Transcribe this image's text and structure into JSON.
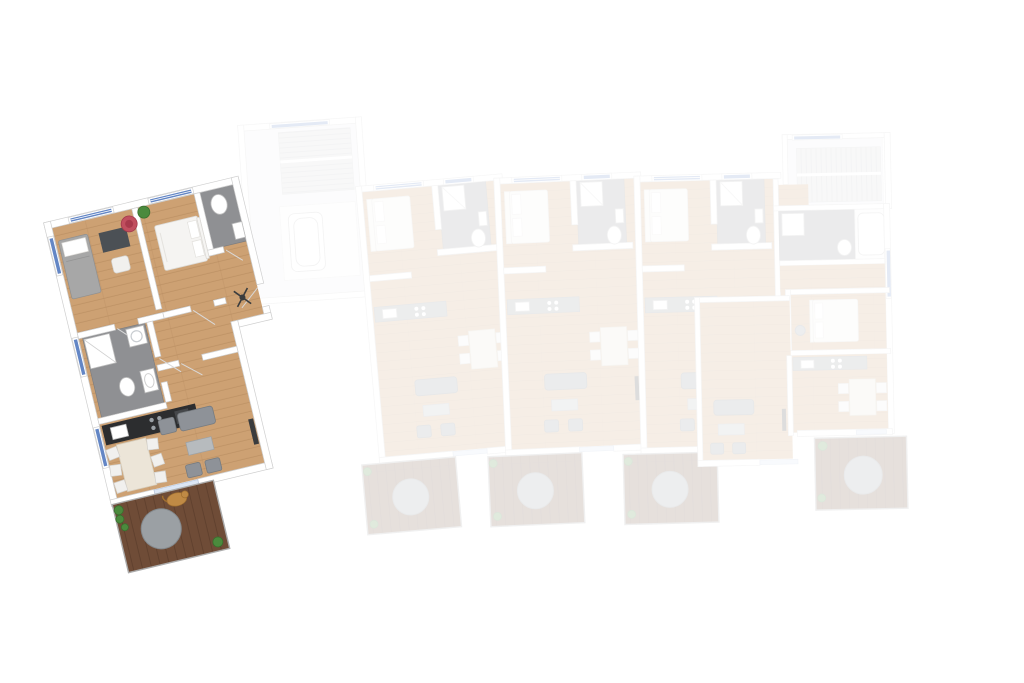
{
  "scene": {
    "kind": "residential-floor-plan-3d-top-view",
    "units_total": 5,
    "highlighted_unit": "unit-1",
    "faded_units": 4,
    "stair_cores": 2
  },
  "colors": {
    "background": "#ffffff",
    "wall_fill": "#ffffff",
    "wall_stroke": "#cfcfcf",
    "wood_floor": "#cda173",
    "wood_plank_line": "#b78c5f",
    "deck_wood": "#6f4c37",
    "deck_plank_line": "#5d3e2c",
    "tile_gray": "#8f9093",
    "tile_dark": "#7a7b7e",
    "window_blue": "#6386c5",
    "window_frame": "#ffffff",
    "glass_blue": "#dce6f4",
    "kitchen_dark": "#2c2d2f",
    "counter_gray": "#92979c",
    "sofa_gray": "#8e9298",
    "sofa_dark": "#767b80",
    "coffee_table": "#b7bbbe",
    "bed_white": "#f5f4f2",
    "bed_outline": "#dcdad6",
    "bed_gray": "#a7a7a7",
    "pillow_white": "#ffffff",
    "chair_white": "#f1f0ee",
    "chair_stroke": "#d2d0cc",
    "desk_dark": "#4b5055",
    "pouf_red": "#c14f5f",
    "plant_green": "#4b8a3d",
    "plant_dark": "#39702e",
    "dog_tan": "#c08a45",
    "stairs_light": "#d7d8da",
    "stairs_stripe": "#bdbfc2",
    "table_round_gray": "#9ba0a4",
    "swing_line": "#d9d9d9",
    "faded_opacity": "0.17"
  },
  "units": [
    {
      "id": "unit-1",
      "state": "highlighted",
      "rooms": [
        "bedroom",
        "master-bedroom",
        "en-suite-wc",
        "bathroom",
        "open-kitchen",
        "living-dining-room",
        "hallway",
        "balcony"
      ],
      "furniture": [
        "single-bed",
        "desk",
        "chair",
        "pouf",
        "double-bed",
        "plant",
        "shower",
        "washing-machine",
        "toilet",
        "sink",
        "kitchen-counter",
        "dining-table",
        "dining-chairs",
        "sofa",
        "armchairs",
        "coffee-table",
        "tv-sideboard",
        "coat-stand",
        "dog",
        "round-balcony-table",
        "balcony-plants"
      ]
    },
    {
      "id": "unit-2",
      "state": "faded",
      "rooms": [
        "bedroom",
        "bathroom",
        "open-kitchen",
        "living-dining-room",
        "balcony"
      ]
    },
    {
      "id": "unit-3",
      "state": "faded",
      "rooms": [
        "bedroom",
        "bathroom",
        "open-kitchen",
        "living-dining-room",
        "balcony"
      ]
    },
    {
      "id": "unit-4",
      "state": "faded",
      "rooms": [
        "bedroom",
        "bathroom",
        "open-kitchen",
        "living-dining-room",
        "balcony"
      ]
    },
    {
      "id": "unit-5",
      "state": "faded",
      "rooms": [
        "corridor",
        "bathroom",
        "bedroom",
        "open-kitchen",
        "living-dining-room",
        "balcony"
      ]
    }
  ],
  "cores": [
    {
      "id": "stair-core-1",
      "features": [
        "staircase",
        "utility-room"
      ]
    },
    {
      "id": "stair-core-2",
      "features": [
        "staircase"
      ]
    }
  ]
}
